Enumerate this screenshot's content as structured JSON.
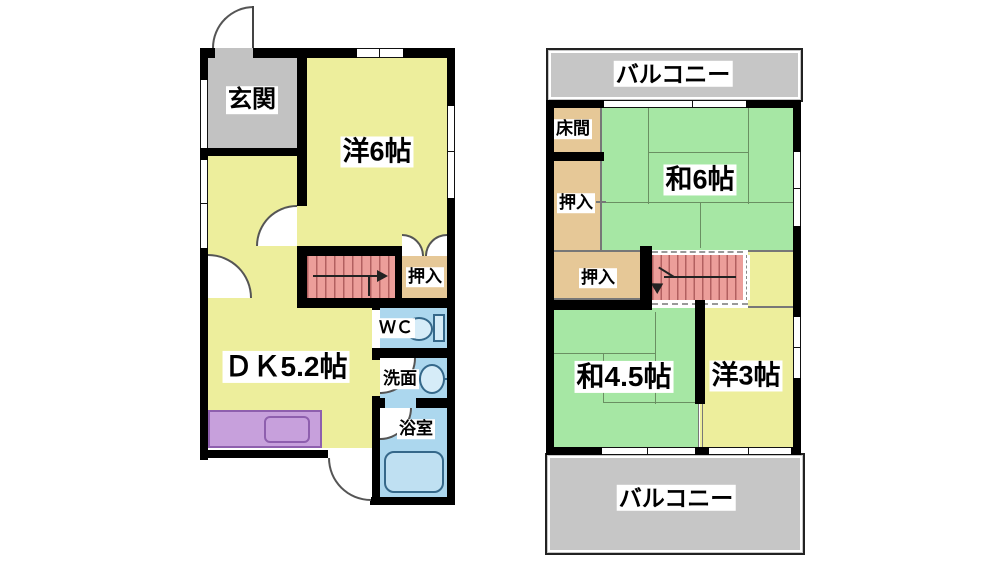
{
  "colors": {
    "room_yellow": "#EDEE9C",
    "room_green": "#A6E7A4",
    "closet_tan": "#E6C897",
    "water_blue": "#ACD7EE",
    "entry_gray": "#C2C2C2",
    "balcony_gray": "#C6C6C6",
    "stairs_pink": "#EC9E9A",
    "stairs_stripe": "#B26060",
    "counter_purple": "#C7A0DC",
    "counter_border": "#8E5FAE"
  },
  "floor1": {
    "genkan": "玄関",
    "western6": "洋6帖",
    "closet": "押入",
    "dk": "ＤＫ5.2帖",
    "wc": "ＷＣ",
    "washroom": "洗面",
    "bathroom": "浴室"
  },
  "floor2": {
    "balcony_top": "バルコニー",
    "tokonoma": "床間",
    "japanese6": "和6帖",
    "closet_left": "押入",
    "closet_mid": "押入",
    "japanese45": "和4.5帖",
    "western3": "洋3帖",
    "balcony_bottom": "バルコニー"
  }
}
